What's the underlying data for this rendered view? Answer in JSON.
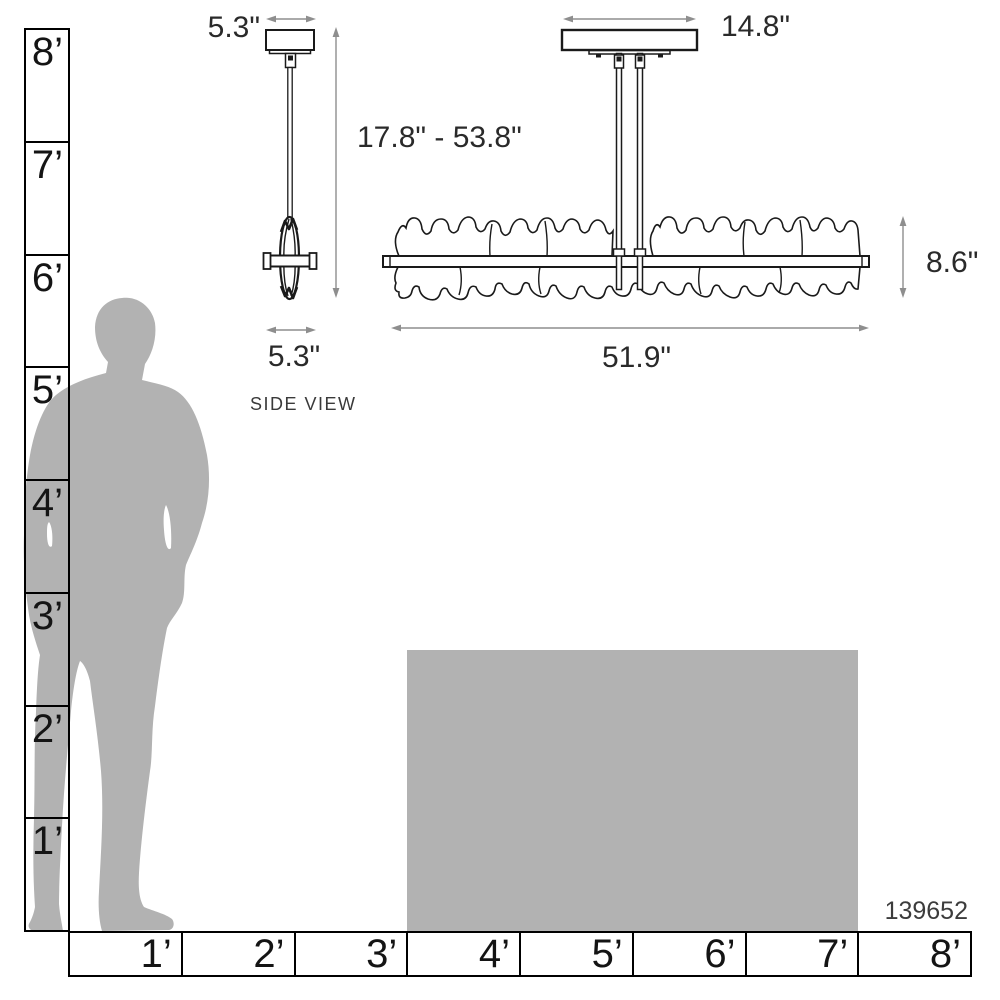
{
  "product_code": "139652",
  "side_view": {
    "label": "SIDE VIEW",
    "canopy_width": "5.3\"",
    "height_range": "17.8\" - 53.8\"",
    "fixture_width": "5.3\""
  },
  "front_view": {
    "canopy_width": "14.8\"",
    "fixture_width": "51.9\"",
    "fixture_height": "8.6\""
  },
  "scale_rulers": {
    "vertical_labels": [
      "8’",
      "7’",
      "6’",
      "5’",
      "4’",
      "3’",
      "2’",
      "1’"
    ],
    "horizontal_labels": [
      "1’",
      "2’",
      "3’",
      "4’",
      "5’",
      "6’",
      "7’",
      "8’"
    ]
  },
  "colors": {
    "silhouette_gray": "#b2b2b2",
    "table_gray": "#b2b2b2",
    "outline_black": "#1a1a1a",
    "dimension_gray": "#8e8e8e",
    "ruler_line": "#000000"
  }
}
